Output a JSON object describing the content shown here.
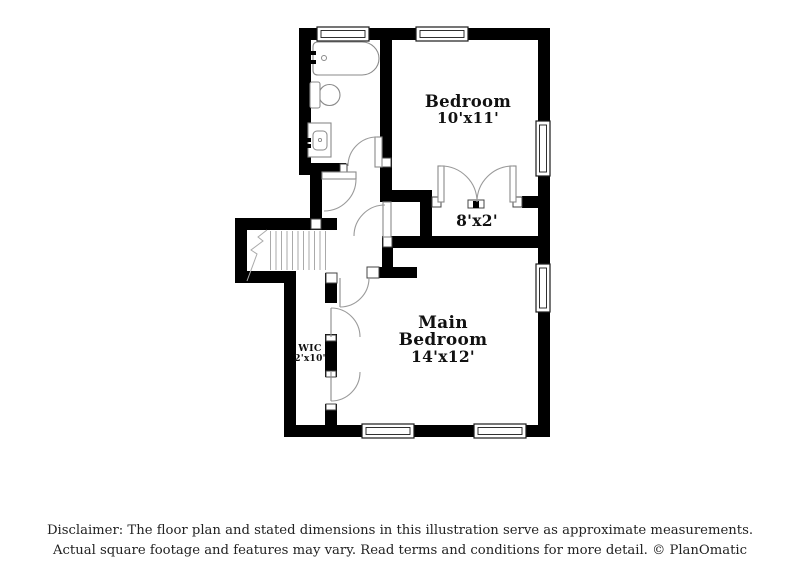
{
  "floor_plan": {
    "rooms": {
      "bedroom": {
        "name": "Bedroom",
        "dims": "10'x11'"
      },
      "hall": {
        "dims": "8'x2'"
      },
      "main_bedroom": {
        "name": "Main Bedroom",
        "dims": "14'x12'"
      },
      "wic": {
        "name": "WIC",
        "dims": "2'x10'"
      }
    },
    "fixtures": [
      "bathtub",
      "toilet",
      "sink-vanity",
      "staircase"
    ],
    "colors": {
      "wall": "#000000",
      "fixture_line": "#8a8a8a",
      "door_arc": "#9a9a9a",
      "stair_tread": "#aaaaaa",
      "background": "#ffffff",
      "label_text": "#111111"
    }
  },
  "disclaimer": {
    "line1": "Disclaimer: The floor plan and stated dimensions in this illustration serve as approximate measurements.",
    "line2": "Actual square footage and features may vary. Read terms and conditions for more detail. © PlanOmatic"
  }
}
